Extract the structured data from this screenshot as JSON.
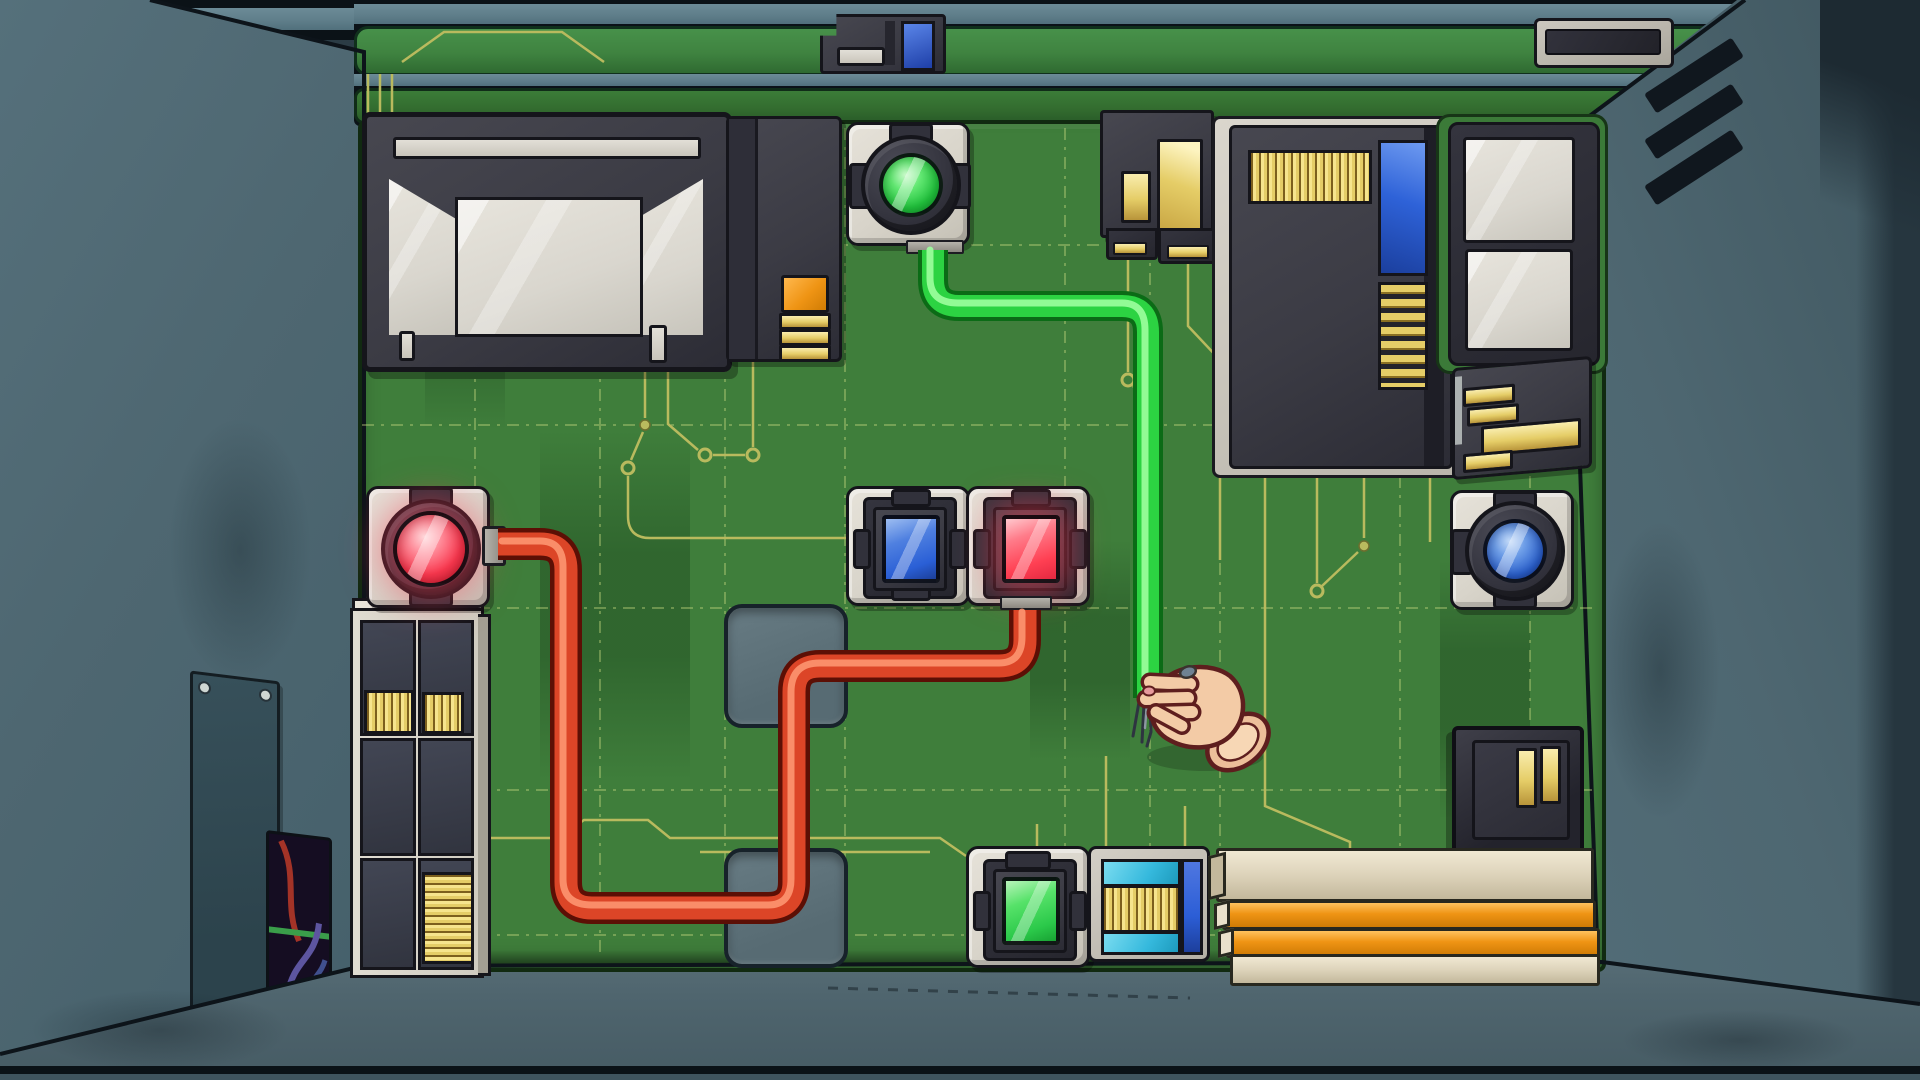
{
  "scene": {
    "description": "Top-down game view inside an opened wall service box: a green circuit board panel with lit buttons, a red cable joining two red buttons, and a green cable whose frayed end is pinched by the player's hand",
    "room_label": "inside of wall-mounted electronics box",
    "board_label": "green circuit board back panel",
    "floor_label": "box floor",
    "ceiling_label": "box ceiling lip",
    "wall_left_label": "left interior wall",
    "wall_right_label": "right interior wall"
  },
  "colors": {
    "board": "#3f7e3b",
    "board_strip": "#3f8340",
    "wall": "#4e6771",
    "wall_outer": "#2b3c45",
    "ceiling": "#5e7d89",
    "floor": "#4f656e",
    "plate": "#d8d4ca",
    "frame": "#3b3b44",
    "outline": "#15151b",
    "gold": "#e5cd67",
    "orange": "#ef9414",
    "beige": "#ddd3ba",
    "trace": "#b9ba5e",
    "cable_red": "#dc4527",
    "cable_green": "#2cd342",
    "glass_red": "#fa3950",
    "glass_green": "#22c23e",
    "glass_blue": "#2d63cf",
    "screen_glass": "#d9d6ce",
    "skin": "#f3cba6"
  },
  "buttons": {
    "round_red": {
      "label": "large round red button (lit)",
      "shape": "round",
      "color": "red",
      "state": "lit"
    },
    "round_green": {
      "label": "large round green button (lit)",
      "shape": "round",
      "color": "green",
      "state": "lit"
    },
    "round_blue": {
      "label": "large round blue button",
      "shape": "round",
      "color": "blue",
      "state": "idle"
    },
    "square_blue": {
      "label": "square blue indicator button",
      "shape": "square",
      "color": "blue",
      "state": "idle"
    },
    "square_red": {
      "label": "square red indicator button (lit)",
      "shape": "square",
      "color": "red",
      "state": "lit"
    },
    "square_green": {
      "label": "square green indicator button (lit)",
      "shape": "square",
      "color": "green",
      "state": "lit"
    }
  },
  "cables": {
    "red_cable": {
      "label": "red cable",
      "color": "red",
      "from": "round red button",
      "to": "square red button"
    },
    "green_cable": {
      "label": "green cable",
      "color": "green",
      "from": "round green button",
      "to": "loose frayed end"
    },
    "frayed_end": {
      "label": "frayed bare wires at end of green cable"
    }
  },
  "hand": {
    "label": "player's hand pinching the frayed end of the green cable"
  },
  "modules": {
    "display_screen": {
      "label": "dark display unit with glass window"
    },
    "card_reader": {
      "label": "reader module with orange pad and gold contacts"
    },
    "cable_socket_top": {
      "label": "black connector block with gold slots"
    },
    "chip_module": {
      "label": "large chip module with gold pin header and blue slot"
    },
    "label_panels": {
      "label": "frame with two blank grey panels"
    },
    "pin_connector": {
      "label": "edge connector with gold pins"
    },
    "socket_box": {
      "label": "socket box with two gold contacts"
    },
    "equipment_rack": {
      "label": "shelf rack with gold striped cartridges"
    },
    "wall_access_panel": {
      "label": "screwed access panel on left wall"
    },
    "wall_opening": {
      "label": "dark wall opening with wiring inside"
    },
    "cyan_reader": {
      "label": "socket with cyan bars and gold grill"
    },
    "bar_stack": {
      "label": "stack of beige and orange expansion bars"
    },
    "mini_connector": {
      "label": "small connector with blue cell on top strip"
    },
    "corner_display": {
      "label": "small grey-framed display, top right"
    },
    "vent_grille": {
      "label": "three vent slats on right wall"
    },
    "recess_upper": {
      "label": "upper recessed channel in board"
    },
    "recess_lower": {
      "label": "lower recessed channel in board"
    }
  }
}
